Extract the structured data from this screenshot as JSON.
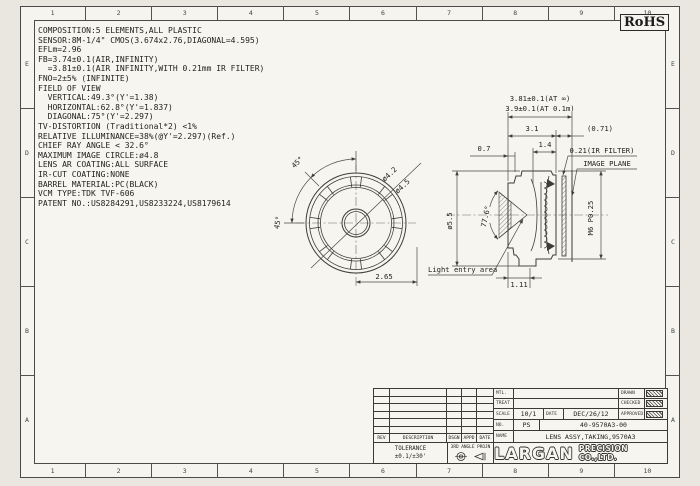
{
  "page": {
    "rohs_label": "RoHS"
  },
  "border": {
    "columns": [
      "1",
      "2",
      "3",
      "4",
      "5",
      "6",
      "7",
      "8",
      "9",
      "10"
    ],
    "rows": [
      "E",
      "D",
      "C",
      "B",
      "A"
    ]
  },
  "specs": {
    "lines": [
      "COMPOSITION:5 ELEMENTS,ALL PLASTIC",
      "SENSOR:8M-1/4\" CMOS(3.674x2.76,DIAGONAL=4.595)",
      "EFLm=2.96",
      "FB=3.74±0.1(AIR,INFINITY)",
      "  =3.81±0.1(AIR INFINITY,WITH 0.21mm IR FILTER)",
      "FNO=2±5% (INFINITE)",
      "FIELD OF VIEW",
      "  VERTICAL:49.3°(Y'=1.38)",
      "  HORIZONTAL:62.8°(Y'=1.837)",
      "  DIAGONAL:75°(Y'=2.297)",
      "TV-DISTORTION (Traditional*2) <1%",
      "RELATIVE ILLUMINANCE=38%(@Y'=2.297)(Ref.)",
      "CHIEF RAY ANGLE < 32.6°",
      "MAXIMUM IMAGE CIRCLE:ø4.8",
      "LENS AR COATING:ALL SURFACE",
      "IR-CUT COATING:NONE",
      "BARREL MATERIAL:PC(BLACK)",
      "VCM TYPE:TDK TVF-606",
      "PATENT NO.:US8284291,US8233224,US8179614"
    ]
  },
  "front_view": {
    "angle_1": "45°",
    "angle_2": "45°",
    "dia_inner": "ø4.2",
    "dia_outer": "ø4.5",
    "offset": "2.65"
  },
  "section_view": {
    "fb_inf": "3.81±0.1(AT ∞)",
    "fb_near": "3.9±0.1(AT 0.1m)",
    "barrel_length": "3.1",
    "back_focus_ref": "(0.71)",
    "rear_section": "1.4",
    "ir_filter": "0.21(IR FILTER)",
    "image_plane": "IMAGE PLANE",
    "front_step": "0.7",
    "barrel_diameter": "ø5.5",
    "entry_cone_angle": "77.6°",
    "thread_spec": "M6 P0.25",
    "front_flange": "1.11",
    "light_entry": "Light entry area"
  },
  "title_block": {
    "labels": {
      "mtl": "MTL.",
      "treat": "TREAT",
      "scale": "SCALE",
      "date": "DATE",
      "no": "NO.",
      "name": "NAME",
      "drawn": "DRAWN",
      "checked": "CHECKED",
      "approved": "APPROVED"
    },
    "values": {
      "scale": "10/1",
      "date": "DEC/26/12",
      "no_prefix": "PS",
      "drawing_no": "40-9570A3-00",
      "part_name": "LENS ASSY,TAKING,9570A3"
    },
    "revision": {
      "headers": [
        "REV",
        "DESCRIPTION",
        "DSGN",
        "APPD",
        "DATE"
      ]
    },
    "tolerance": {
      "label": "TOLERANCE",
      "value": "±0.1/±30'"
    },
    "projection": {
      "label": "3RD ANGLE PROJN"
    },
    "company": {
      "name": "LARGAN",
      "suffix": "PRECISION CO.,LTD."
    }
  }
}
